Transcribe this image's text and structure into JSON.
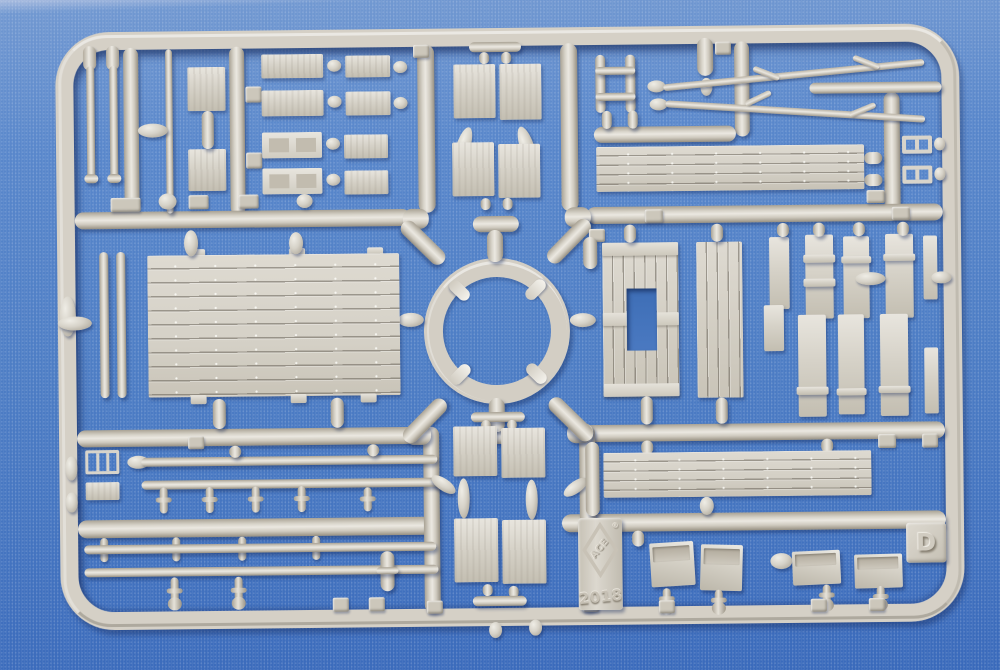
{
  "photo": {
    "subject": "Grey injection-molded plastic model kit sprue photographed on blue fabric",
    "markings": {
      "sprue_letter": "D",
      "mold_year": "2018",
      "brand": "ACE",
      "registered_mark": "®"
    },
    "colors": {
      "fabric_blue": "#4c7cc4",
      "fabric_highlight": "#a9bcdf",
      "fabric_shadow": "#3a6abb",
      "plastic_base": "#d5d0c6",
      "plastic_highlight": "#ebe8e1",
      "plastic_shadow": "#948d80"
    }
  }
}
